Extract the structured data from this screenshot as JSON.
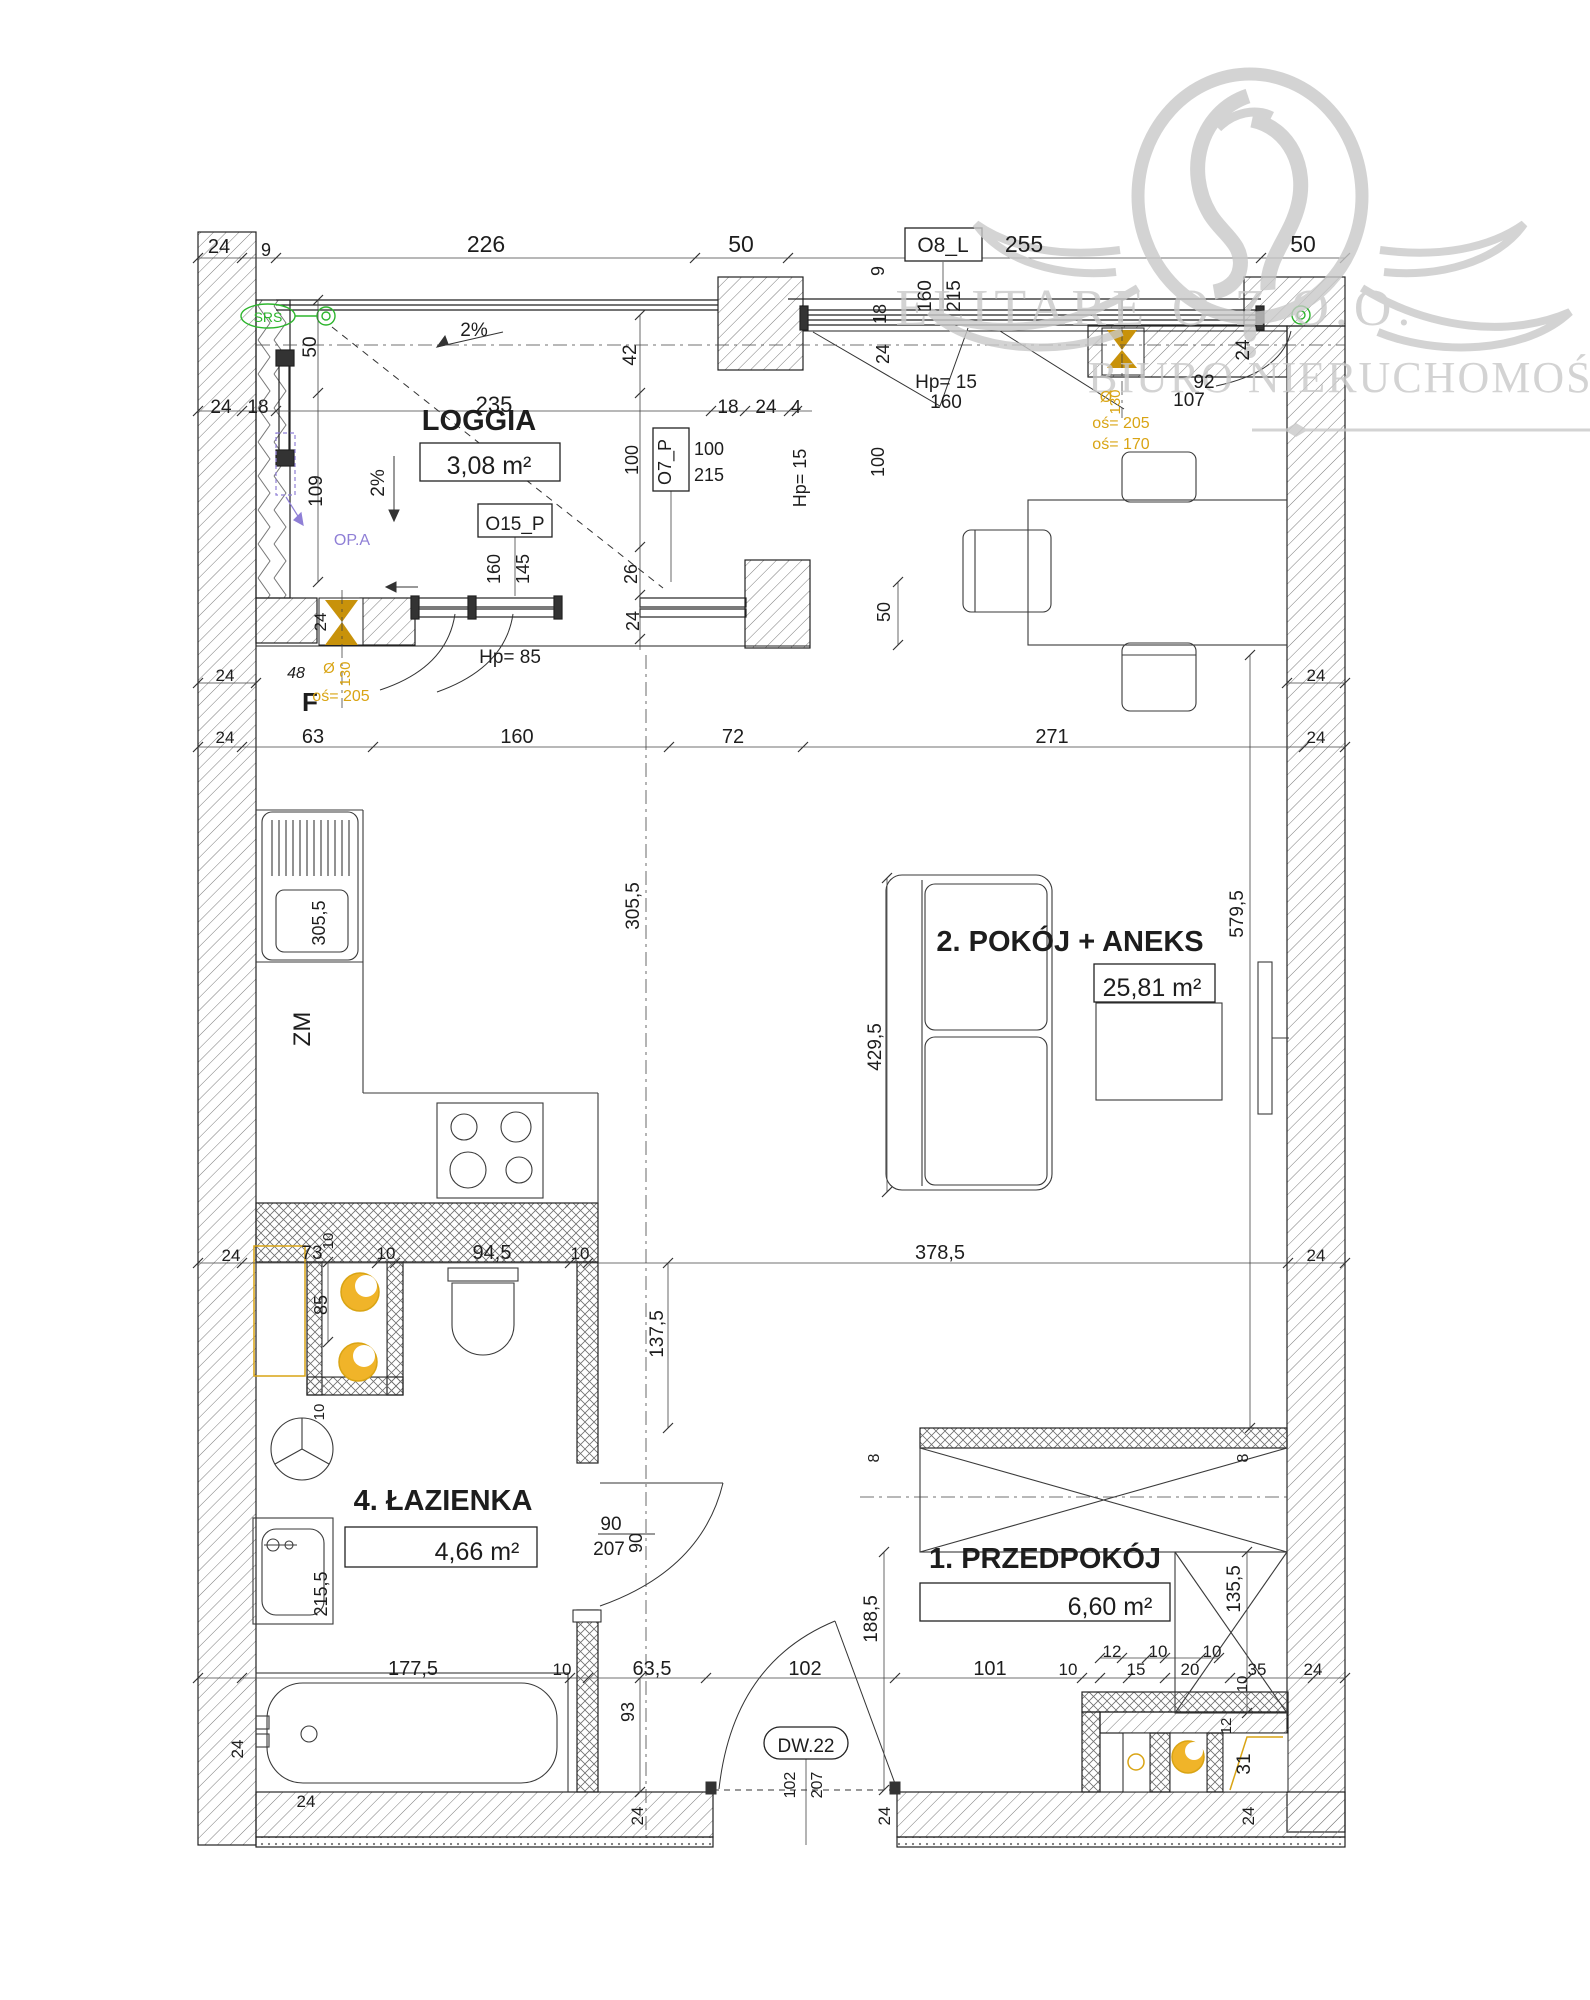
{
  "meta": {
    "type": "apartment-floor-plan",
    "language": "pl"
  },
  "watermark": {
    "brand_left": "ELITARE",
    "brand_right": "O Z O.O.",
    "subtitle": "BIURO NIERUCHOMOŚCI",
    "color": "#c9c9c9"
  },
  "rooms": [
    {
      "name": "LOGGIA",
      "area": "3,08 m²"
    },
    {
      "name": "2. POKÓJ + ANEKS",
      "area": "25,81 m²"
    },
    {
      "name": "4. ŁAZIENKA",
      "area": "4,66 m²"
    },
    {
      "name": "1. PRZEDPOKÓJ",
      "area": "6,60 m²"
    }
  ],
  "openings": {
    "window_top": "O8_L",
    "window_loggia_side": "O7_P",
    "window_balcony": "O15_P",
    "entry_door": "DW.22"
  },
  "colors": {
    "k": "#1d1d1d",
    "y": "#d9a414",
    "g": "#2db52d",
    "v": "#8f7fd6",
    "w": "#c9c9c9",
    "gold": "#c8920a"
  },
  "labels": [
    {
      "t": "24",
      "x": 219,
      "y": 253,
      "s": 20
    },
    {
      "t": "9",
      "x": 266,
      "y": 256,
      "s": 18
    },
    {
      "t": "226",
      "x": 486,
      "y": 252,
      "s": 23
    },
    {
      "t": "50",
      "x": 741,
      "y": 252,
      "s": 23
    },
    {
      "t": "255",
      "x": 1024,
      "y": 252,
      "s": 23
    },
    {
      "t": "50",
      "x": 1303,
      "y": 252,
      "s": 23
    },
    {
      "t": "O8_L",
      "x": 943,
      "y": 252,
      "s": 21,
      "n": "tag-window-o8l"
    },
    {
      "t": "24",
      "x": 221,
      "y": 413,
      "s": 19
    },
    {
      "t": "18",
      "x": 258,
      "y": 413,
      "s": 19
    },
    {
      "t": "235",
      "x": 494,
      "y": 412,
      "s": 22
    },
    {
      "t": "18",
      "x": 728,
      "y": 413,
      "s": 19
    },
    {
      "t": "24",
      "x": 766,
      "y": 413,
      "s": 19
    },
    {
      "t": "4",
      "x": 796,
      "y": 413,
      "s": 18
    },
    {
      "t": "9",
      "x": 884,
      "y": 271,
      "r": -90,
      "s": 18
    },
    {
      "t": "160",
      "x": 931,
      "y": 296,
      "r": -90,
      "s": 19
    },
    {
      "t": "215",
      "x": 960,
      "y": 296,
      "r": -90,
      "s": 19
    },
    {
      "t": "18",
      "x": 886,
      "y": 314,
      "r": -90,
      "s": 18
    },
    {
      "t": "24",
      "x": 889,
      "y": 354,
      "r": -90,
      "s": 18
    },
    {
      "t": "Hp= 15",
      "x": 946,
      "y": 388,
      "s": 19
    },
    {
      "t": "160",
      "x": 946,
      "y": 408,
      "s": 19
    },
    {
      "t": "92",
      "x": 1204,
      "y": 388,
      "s": 19
    },
    {
      "t": "107",
      "x": 1189,
      "y": 406,
      "s": 19
    },
    {
      "t": "24",
      "x": 1249,
      "y": 350,
      "r": -90,
      "s": 19
    },
    {
      "t": "50",
      "x": 316,
      "y": 347,
      "r": -90,
      "s": 19
    },
    {
      "t": "42",
      "x": 636,
      "y": 355,
      "r": -90,
      "s": 19
    },
    {
      "t": "109",
      "x": 322,
      "y": 491,
      "r": -90,
      "s": 19
    },
    {
      "t": "2%",
      "x": 474,
      "y": 336,
      "s": 19,
      "n": "slope-label"
    },
    {
      "t": "2%",
      "x": 384,
      "y": 483,
      "r": -90,
      "s": 19,
      "n": "slope-label"
    },
    {
      "t": "LOGGIA",
      "x": 479,
      "y": 430,
      "s": 29,
      "b": 1,
      "n": "room-label-loggia"
    },
    {
      "t": "3,08 m²",
      "x": 489,
      "y": 474,
      "s": 25,
      "n": "room-area-loggia"
    },
    {
      "t": "O15_P",
      "x": 515,
      "y": 530,
      "s": 19,
      "n": "tag-window-o15p"
    },
    {
      "t": "160",
      "x": 500,
      "y": 569,
      "r": -90,
      "s": 18
    },
    {
      "t": "145",
      "x": 529,
      "y": 569,
      "r": -90,
      "s": 18
    },
    {
      "t": "26",
      "x": 637,
      "y": 574,
      "r": -90,
      "s": 18
    },
    {
      "t": "24",
      "x": 639,
      "y": 621,
      "r": -90,
      "s": 18
    },
    {
      "t": "O7_P",
      "x": 671,
      "y": 462,
      "r": -90,
      "s": 18,
      "n": "tag-window-o7p"
    },
    {
      "t": "100",
      "x": 709,
      "y": 455,
      "s": 18
    },
    {
      "t": "215",
      "x": 709,
      "y": 481,
      "s": 18
    },
    {
      "t": "Hp= 15",
      "x": 806,
      "y": 478,
      "r": -90,
      "s": 18
    },
    {
      "t": "100",
      "x": 638,
      "y": 460,
      "r": -90,
      "s": 18
    },
    {
      "t": "100",
      "x": 884,
      "y": 462,
      "r": -90,
      "s": 18
    },
    {
      "t": "Hp= 85",
      "x": 510,
      "y": 663,
      "s": 19
    },
    {
      "t": "24",
      "x": 326,
      "y": 622,
      "r": -90,
      "s": 17
    },
    {
      "t": "48",
      "x": 296,
      "y": 678,
      "s": 16,
      "i": 1
    },
    {
      "t": "F",
      "x": 310,
      "y": 711,
      "s": 26,
      "b": 1,
      "n": "kitchen-f-label"
    },
    {
      "t": "Ø",
      "x": 329,
      "y": 673,
      "s": 15,
      "c": "y"
    },
    {
      "t": "130",
      "x": 350,
      "y": 674,
      "r": -90,
      "s": 15,
      "c": "y"
    },
    {
      "t": "oś= 205",
      "x": 341,
      "y": 701,
      "s": 16,
      "c": "y"
    },
    {
      "t": "24",
      "x": 225,
      "y": 681,
      "s": 17
    },
    {
      "t": "24",
      "x": 1316,
      "y": 681,
      "s": 17
    },
    {
      "t": "63",
      "x": 313,
      "y": 743,
      "s": 20
    },
    {
      "t": "160",
      "x": 517,
      "y": 743,
      "s": 20
    },
    {
      "t": "72",
      "x": 733,
      "y": 743,
      "s": 20
    },
    {
      "t": "271",
      "x": 1052,
      "y": 743,
      "s": 20
    },
    {
      "t": "24",
      "x": 225,
      "y": 743,
      "s": 17
    },
    {
      "t": "24",
      "x": 1316,
      "y": 743,
      "s": 17
    },
    {
      "t": "50",
      "x": 890,
      "y": 612,
      "r": -90,
      "s": 18
    },
    {
      "t": "305,5",
      "x": 639,
      "y": 906,
      "r": -90,
      "s": 19
    },
    {
      "t": "305,5",
      "x": 325,
      "y": 923,
      "r": -90,
      "s": 18
    },
    {
      "t": "ZM",
      "x": 310,
      "y": 1029,
      "r": -90,
      "s": 24,
      "n": "dishwasher-label"
    },
    {
      "t": "2. POKÓJ + ANEKS",
      "x": 1070,
      "y": 951,
      "s": 29,
      "b": 1,
      "n": "room-label-pokoj"
    },
    {
      "t": "25,81 m²",
      "x": 1152,
      "y": 996,
      "s": 25,
      "n": "room-area-pokoj"
    },
    {
      "t": "429,5",
      "x": 881,
      "y": 1047,
      "r": -90,
      "s": 19
    },
    {
      "t": "579,5",
      "x": 1243,
      "y": 914,
      "r": -90,
      "s": 19
    },
    {
      "t": "24",
      "x": 231,
      "y": 1261,
      "s": 17
    },
    {
      "t": "73",
      "x": 312,
      "y": 1259,
      "s": 19
    },
    {
      "t": "10",
      "x": 333,
      "y": 1241,
      "r": -90,
      "s": 15
    },
    {
      "t": "10",
      "x": 386,
      "y": 1259,
      "s": 17
    },
    {
      "t": "94,5",
      "x": 492,
      "y": 1259,
      "s": 20
    },
    {
      "t": "10",
      "x": 580,
      "y": 1259,
      "s": 17
    },
    {
      "t": "378,5",
      "x": 940,
      "y": 1259,
      "s": 20
    },
    {
      "t": "24",
      "x": 1316,
      "y": 1261,
      "s": 17
    },
    {
      "t": "85",
      "x": 327,
      "y": 1305,
      "r": -90,
      "s": 18
    },
    {
      "t": "10",
      "x": 324,
      "y": 1412,
      "r": -90,
      "s": 15
    },
    {
      "t": "137,5",
      "x": 663,
      "y": 1334,
      "r": -90,
      "s": 19
    },
    {
      "t": "4. ŁAZIENKA",
      "x": 443,
      "y": 1510,
      "s": 29,
      "b": 1,
      "n": "room-label-lazienka"
    },
    {
      "t": "4,66 m²",
      "x": 477,
      "y": 1560,
      "s": 25,
      "n": "room-area-lazienka"
    },
    {
      "t": "215,5",
      "x": 327,
      "y": 1594,
      "r": -90,
      "s": 18
    },
    {
      "t": "90",
      "x": 611,
      "y": 1530,
      "s": 19
    },
    {
      "t": "207",
      "x": 609,
      "y": 1555,
      "s": 19
    },
    {
      "t": "90",
      "x": 642,
      "y": 1543,
      "r": -90,
      "s": 18
    },
    {
      "t": "8",
      "x": 879,
      "y": 1458,
      "r": -90,
      "s": 16
    },
    {
      "t": "8",
      "x": 1248,
      "y": 1458,
      "r": -90,
      "s": 16
    },
    {
      "t": "1. PRZEDPOKÓJ",
      "x": 1045,
      "y": 1568,
      "s": 29,
      "b": 1,
      "n": "room-label-przedpokoj"
    },
    {
      "t": "6,60 m²",
      "x": 1110,
      "y": 1615,
      "s": 25,
      "n": "room-area-przedpokoj"
    },
    {
      "t": "135,5",
      "x": 1240,
      "y": 1589,
      "r": -90,
      "s": 19
    },
    {
      "t": "188,5",
      "x": 877,
      "y": 1619,
      "r": -90,
      "s": 19
    },
    {
      "t": "177,5",
      "x": 413,
      "y": 1675,
      "s": 20
    },
    {
      "t": "10",
      "x": 562,
      "y": 1675,
      "s": 17
    },
    {
      "t": "63,5",
      "x": 652,
      "y": 1675,
      "s": 20
    },
    {
      "t": "102",
      "x": 805,
      "y": 1675,
      "s": 20
    },
    {
      "t": "101",
      "x": 990,
      "y": 1675,
      "s": 20
    },
    {
      "t": "12",
      "x": 1112,
      "y": 1657,
      "s": 17
    },
    {
      "t": "10",
      "x": 1158,
      "y": 1657,
      "s": 17
    },
    {
      "t": "10",
      "x": 1212,
      "y": 1657,
      "s": 17
    },
    {
      "t": "10",
      "x": 1068,
      "y": 1675,
      "s": 17
    },
    {
      "t": "15",
      "x": 1136,
      "y": 1675,
      "s": 17
    },
    {
      "t": "20",
      "x": 1190,
      "y": 1675,
      "s": 17
    },
    {
      "t": "35",
      "x": 1257,
      "y": 1675,
      "s": 17
    },
    {
      "t": "24",
      "x": 1313,
      "y": 1675,
      "s": 17
    },
    {
      "t": "93",
      "x": 634,
      "y": 1712,
      "r": -90,
      "s": 18
    },
    {
      "t": "10",
      "x": 1247,
      "y": 1684,
      "r": -90,
      "s": 15
    },
    {
      "t": "12",
      "x": 1231,
      "y": 1726,
      "r": -90,
      "s": 15
    },
    {
      "t": "31",
      "x": 1250,
      "y": 1764,
      "r": -90,
      "s": 19
    },
    {
      "t": "DW.22",
      "x": 806,
      "y": 1752,
      "s": 19,
      "n": "tag-door-dw22"
    },
    {
      "t": "102",
      "x": 795,
      "y": 1785,
      "r": -90,
      "s": 16
    },
    {
      "t": "207",
      "x": 822,
      "y": 1785,
      "r": -90,
      "s": 16
    },
    {
      "t": "24",
      "x": 643,
      "y": 1816,
      "r": -90,
      "s": 17
    },
    {
      "t": "24",
      "x": 890,
      "y": 1816,
      "r": -90,
      "s": 17
    },
    {
      "t": "24",
      "x": 1254,
      "y": 1816,
      "r": -90,
      "s": 17
    },
    {
      "t": "24",
      "x": 243,
      "y": 1749,
      "r": -90,
      "s": 17
    },
    {
      "t": "24",
      "x": 306,
      "y": 1807,
      "s": 17
    },
    {
      "t": "Ø",
      "x": 1106,
      "y": 402,
      "s": 16,
      "c": "y"
    },
    {
      "t": "130",
      "x": 1120,
      "y": 402,
      "r": -90,
      "s": 15,
      "c": "y"
    },
    {
      "t": "oś= 205",
      "x": 1121,
      "y": 428,
      "s": 16,
      "c": "y"
    },
    {
      "t": "oś= 170",
      "x": 1121,
      "y": 449,
      "s": 16,
      "c": "y"
    },
    {
      "t": "SRS",
      "x": 268,
      "y": 322,
      "s": 14,
      "c": "g",
      "n": "annotation-srs"
    },
    {
      "t": "OP.A",
      "x": 352,
      "y": 545,
      "s": 16,
      "c": "v",
      "n": "annotation-opa"
    }
  ]
}
